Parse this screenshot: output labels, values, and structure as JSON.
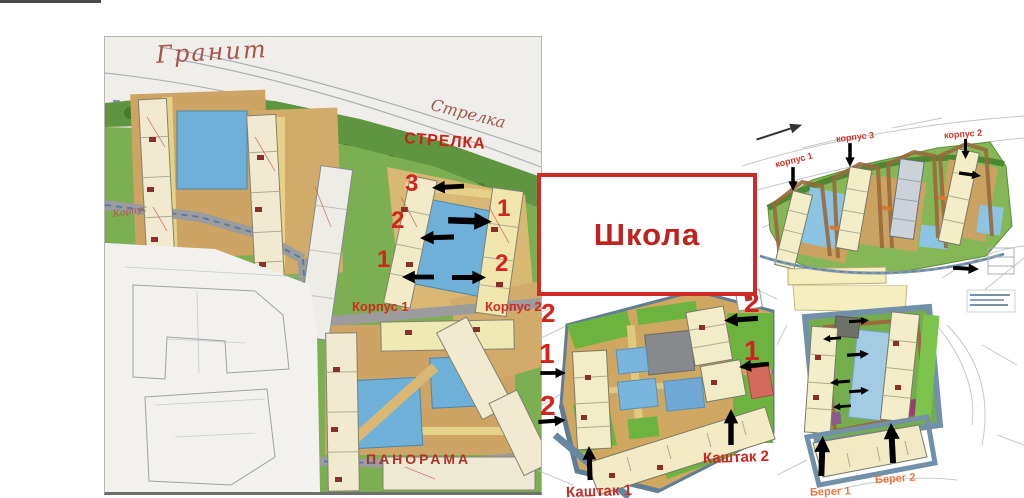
{
  "annotation_colors": {
    "red": "#d2241e",
    "school_border": "#cf2b26",
    "school_text": "#bf231e",
    "handwriting": "#a8544a",
    "orange": "#e0813c"
  },
  "left_map": {
    "granite_label": "Гранит",
    "strelka_handwritten_label": "Стрелка",
    "strelka_label": "СТРЕЛКА",
    "korpus_note": "Корпус",
    "numbers": {
      "left_3": "3",
      "left_2": "2",
      "left_1": "1",
      "right_1": "1",
      "right_2": "2"
    },
    "korpus1_label": "Корпус 1",
    "korpus2_label": "Корпус 2",
    "panorama_label": "ПАНОРАМА"
  },
  "school_box": {
    "label": "Школа"
  },
  "top_right_map": {
    "korpus1_label": "корпус 1",
    "korpus3_label": "корпус 3",
    "korpus2_label": "корпус 2"
  },
  "bottom_middle_map": {
    "numbers": {
      "left_2a": "2",
      "left_1": "1",
      "left_2b": "2",
      "right_2": "2",
      "right_1": "1"
    },
    "kashtak2_label": "Каштак 2",
    "kashtak1_label": "Каштак 1"
  },
  "bottom_right_map": {
    "bereg1_label": "Берег 1",
    "bereg2_label": "Берег 2"
  }
}
